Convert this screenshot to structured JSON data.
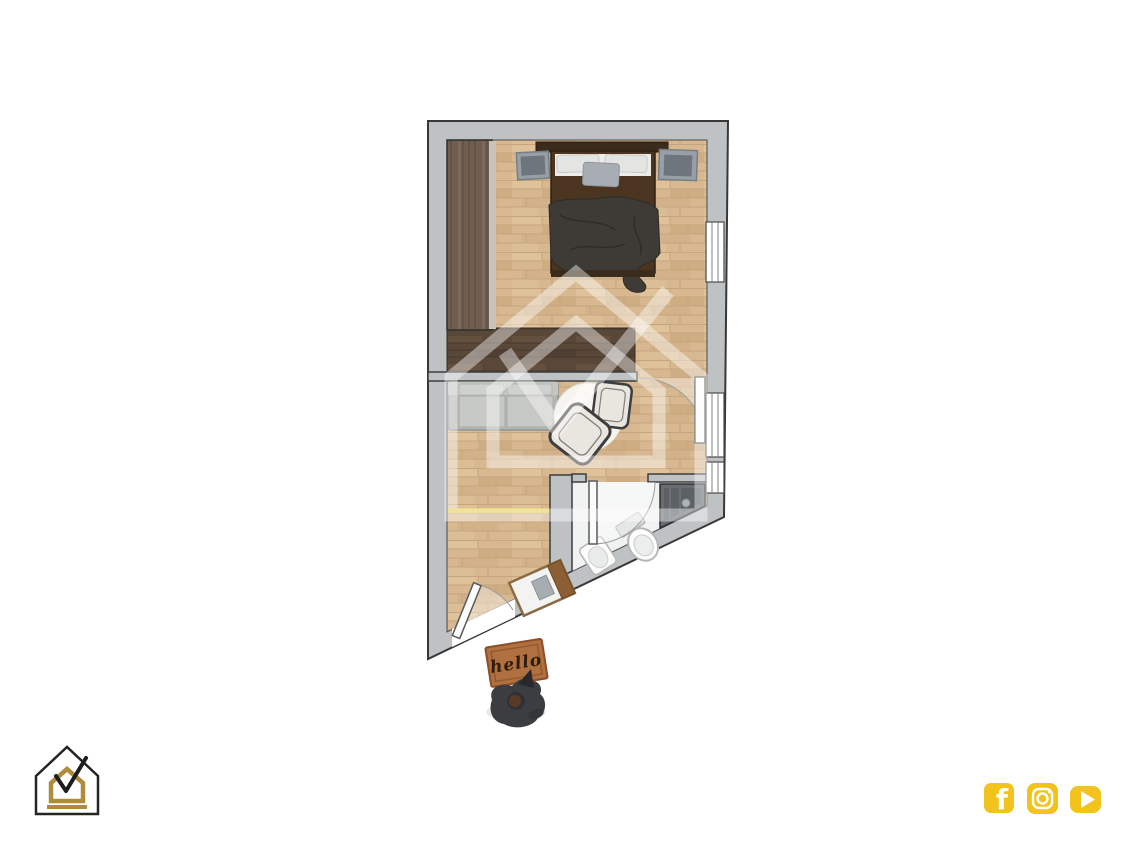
{
  "image": {
    "kind": "apartment floor plan render",
    "background": "#ffffff"
  },
  "floorplan": {
    "rooms": [
      {
        "id": "bedroom",
        "furniture": [
          "wardrobe",
          "double-bed",
          "pillows",
          "nightstand-left",
          "nightstand-right"
        ]
      },
      {
        "id": "living-room",
        "furniture": [
          "sofa",
          "round-rug",
          "armchair",
          "side-chair"
        ]
      },
      {
        "id": "bathroom",
        "fixtures": [
          "shower",
          "toilet",
          "sink"
        ]
      },
      {
        "id": "entry-hall",
        "furniture": [
          "shoe-bench"
        ]
      }
    ],
    "windows_count": 3,
    "doors": [
      "entry-door",
      "bedroom-door",
      "bathroom-door"
    ],
    "doormat": {
      "text": "hello"
    },
    "outside": [
      "dog"
    ]
  },
  "branding": {
    "logo_name": "house-checkmark-logo",
    "watermark_name": "house-checkmark-watermark"
  },
  "social": {
    "icons": [
      "facebook",
      "instagram",
      "youtube"
    ]
  },
  "colors": {
    "wall_gray": "#bfc2c4",
    "floor_light_wood": "#d7b890",
    "floor_dark_wood": "#594737",
    "wardrobe_wood": "#6f5d50",
    "bed_frame": "#4b3521",
    "blanket": "#3e3a35",
    "sofa_gray": "#b3b6b2",
    "bathroom_floor": "#f1f2f2",
    "doormat_brown": "#b0703f",
    "logo_gold": "#b08b3e",
    "logo_black": "#222222",
    "social_yellow": "#f2c31d",
    "watermark_white": "rgba(255,255,255,0.42)"
  }
}
